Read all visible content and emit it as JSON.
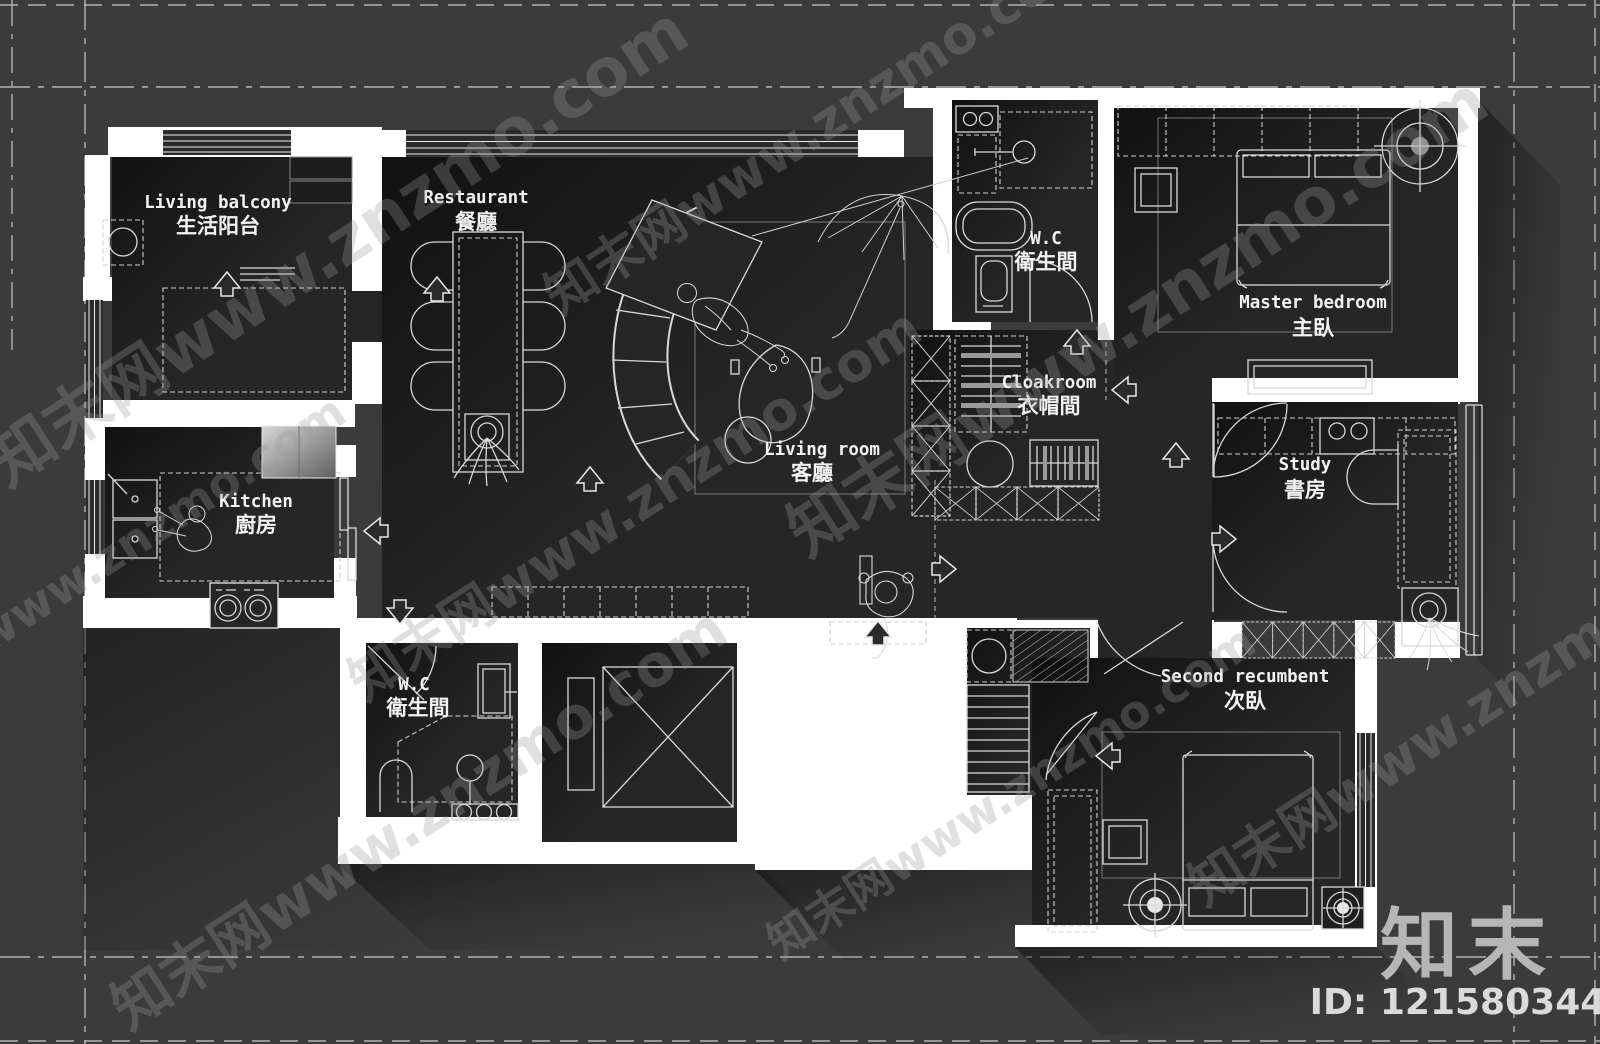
{
  "colors": {
    "background": "#3b3b3b",
    "wall": "#ffffff",
    "line": "#d9d9d9",
    "room_floor": "#262626"
  },
  "rooms": [
    {
      "id": "living-balcony",
      "label_en": "Living balcony",
      "label_zh": "生活阳台"
    },
    {
      "id": "restaurant",
      "label_en": "Restaurant",
      "label_zh": "餐廳"
    },
    {
      "id": "living-room",
      "label_en": "Living room",
      "label_zh": "客廳"
    },
    {
      "id": "kitchen",
      "label_en": "Kitchen",
      "label_zh": "廚房"
    },
    {
      "id": "wc-upper",
      "label_en": "W.C",
      "label_zh": "衛生間"
    },
    {
      "id": "master-bedroom",
      "label_en": "Master bedroom",
      "label_zh": "主臥"
    },
    {
      "id": "cloakroom",
      "label_en": "Cloakroom",
      "label_zh": "衣帽間"
    },
    {
      "id": "study",
      "label_en": "Study",
      "label_zh": "書房"
    },
    {
      "id": "wc-lower",
      "label_en": "W.C",
      "label_zh": "衛生間"
    },
    {
      "id": "second-bedroom",
      "label_en": "Second recumbent",
      "label_zh": "次臥"
    }
  ],
  "watermark": {
    "text": "知末网www.znzmo.com"
  },
  "branding": {
    "logo_text": "知末",
    "id_text": "ID: 1215803446"
  }
}
